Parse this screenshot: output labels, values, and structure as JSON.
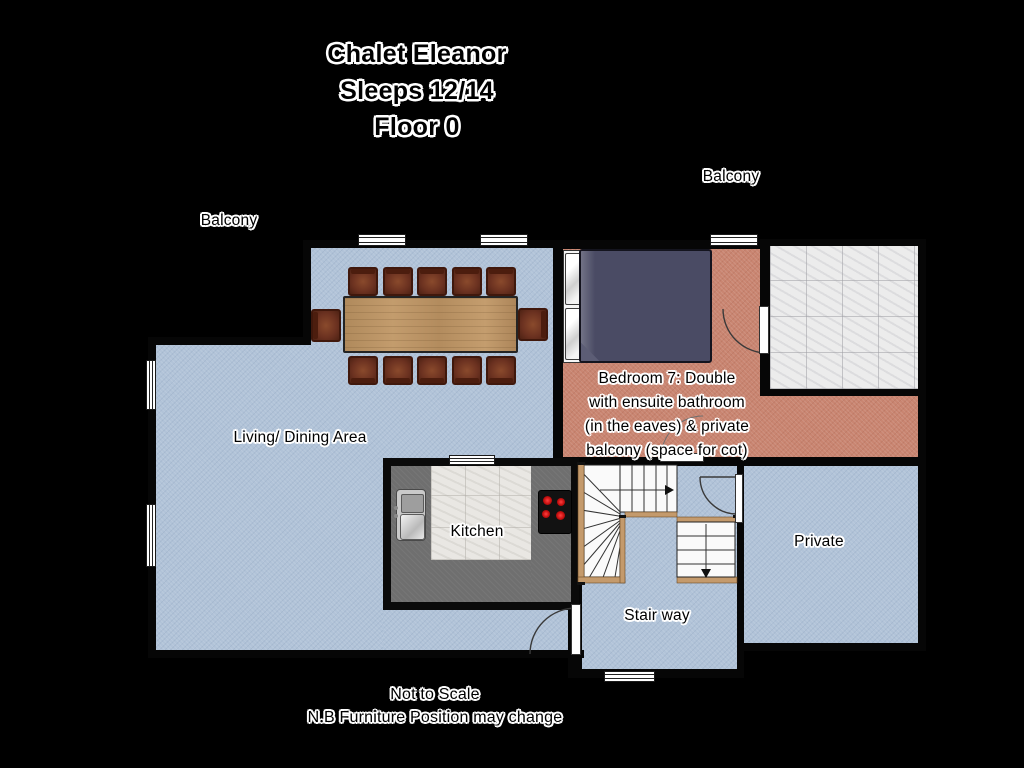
{
  "title": {
    "line1": "Chalet Eleanor",
    "line2": "Sleeps 12/14",
    "line3": "Floor 0"
  },
  "footnotes": {
    "line1": "Not to Scale",
    "line2": "N.B Furniture Position may change"
  },
  "rooms": {
    "living": {
      "label": "Living/ Dining Area"
    },
    "kitchen": {
      "label": "Kitchen"
    },
    "stairway": {
      "label": "Stair way"
    },
    "private": {
      "label": "Private"
    },
    "bedroom": {
      "label_line1": "Bedroom 7: Double",
      "label_line2": "with ensuite bathroom",
      "label_line3": "(in the eaves) & private",
      "label_line4": "balcony (space for cot)"
    },
    "balcony_left": {
      "label": "Balcony"
    },
    "balcony_top": {
      "label": "Balcony"
    }
  },
  "furniture": {
    "dining_table": "dining-table",
    "dining_chair_count": 12,
    "bed": "double-bed-with-pillows",
    "sink": "kitchen-sink",
    "hob": "cooktop-4-burner",
    "stairs": "winder-staircase-with-down-flight"
  },
  "colors": {
    "background": "#000000",
    "floor_blue": "#b1c3d8",
    "floor_pink": "#c98571",
    "balcony_tile": "#ececec",
    "wall": "#060606",
    "counter_gray": "#6f6f6f",
    "table_wood": "#bb9467",
    "chair_brown": "#6b3120",
    "duvet_navy": "#4a4b64",
    "stair_trim": "#c49a6c",
    "burner_red": "#c40f0f"
  }
}
